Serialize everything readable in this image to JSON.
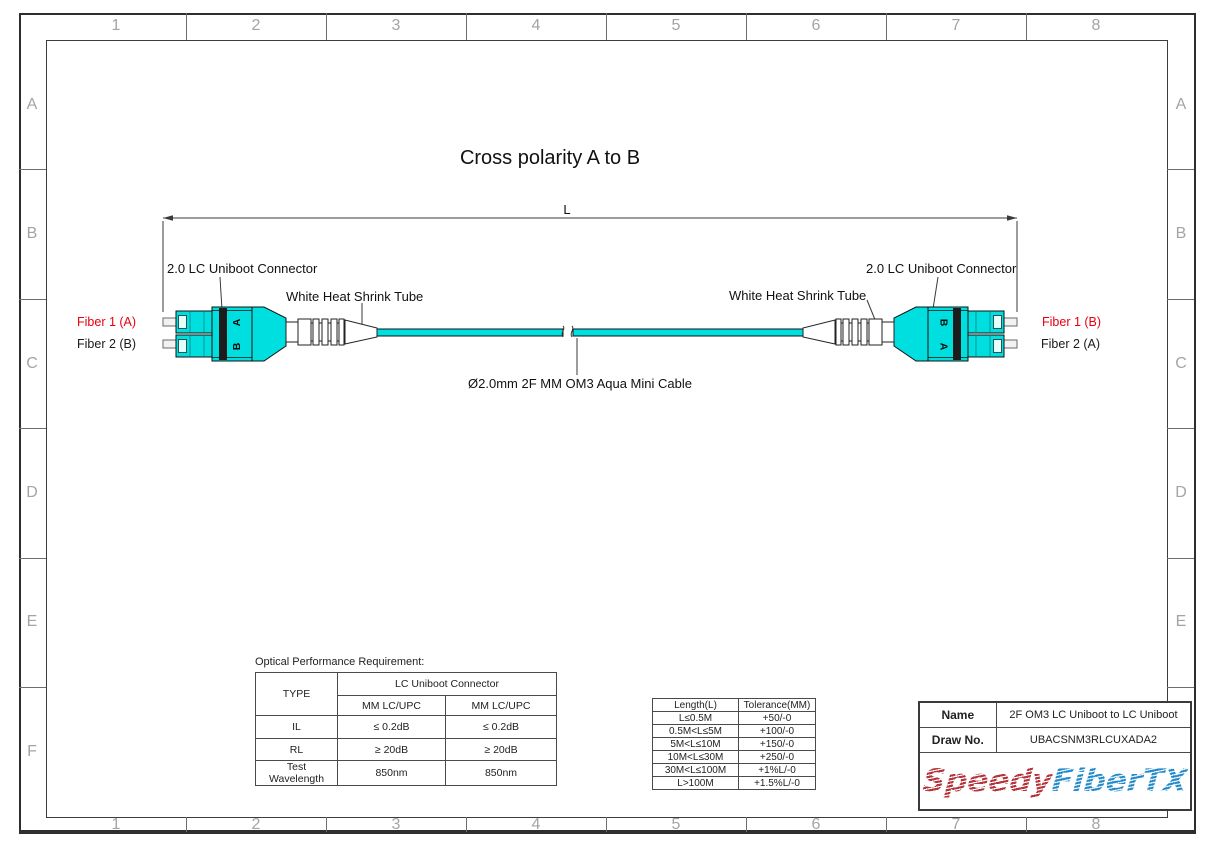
{
  "frame": {
    "columns": [
      "1",
      "2",
      "3",
      "4",
      "5",
      "6",
      "7",
      "8"
    ],
    "rows": [
      "A",
      "B",
      "C",
      "D",
      "E",
      "F"
    ]
  },
  "title": "Cross polarity A to B",
  "diagram": {
    "dimension_label": "L",
    "connector_label_left": "2.0 LC Uniboot Connector",
    "connector_label_right": "2.0 LC Uniboot Connector",
    "heat_shrink_label_left": "White Heat Shrink Tube",
    "heat_shrink_label_right": "White Heat Shrink Tube",
    "cable_label": "Ø2.0mm 2F MM OM3 Aqua Mini Cable",
    "fiber_labels_left": {
      "fiber1": "Fiber 1 (A)",
      "fiber2": "Fiber 2 (B)"
    },
    "fiber_labels_right": {
      "fiber1": "Fiber 1 (B)",
      "fiber2": "Fiber 2 (A)"
    },
    "polarity_letters_left": {
      "top": "A",
      "bottom": "B"
    },
    "polarity_letters_right": {
      "top": "B",
      "bottom": "A"
    },
    "colors": {
      "cable_aqua": "#00dfe0",
      "fiber1_label_red": "#e8000f",
      "heat_shrink_white": "#ffffff"
    }
  },
  "optical_table": {
    "caption": "Optical Performance Requirement:",
    "type_header": "TYPE",
    "group_header": "LC Uniboot Connector",
    "sub_headers": [
      "MM LC/UPC",
      "MM LC/UPC"
    ],
    "rows": [
      {
        "label": "IL",
        "col1": "≤ 0.2dB",
        "col2": "≤ 0.2dB"
      },
      {
        "label": "RL",
        "col1": "≥ 20dB",
        "col2": "≥ 20dB"
      },
      {
        "label": "Test Wavelength",
        "col1": "850nm",
        "col2": "850nm"
      }
    ]
  },
  "tolerance_table": {
    "headers": [
      "Length(L)",
      "Tolerance(MM)"
    ],
    "rows": [
      {
        "length": "L≤0.5M",
        "tolerance": "+50/-0"
      },
      {
        "length": "0.5M<L≤5M",
        "tolerance": "+100/-0"
      },
      {
        "length": "5M<L≤10M",
        "tolerance": "+150/-0"
      },
      {
        "length": "10M<L≤30M",
        "tolerance": "+250/-0"
      },
      {
        "length": "30M<L≤100M",
        "tolerance": "+1%L/-0"
      },
      {
        "length": "L>100M",
        "tolerance": "+1.5%L/-0"
      }
    ]
  },
  "title_block": {
    "name_label": "Name",
    "name_value": "2F OM3 LC Uniboot to LC Uniboot",
    "draw_no_label": "Draw No.",
    "draw_no_value": "UBACSNM3RLCUXADA2",
    "logo": {
      "part1": "Speedy",
      "part2": "FiberTX"
    }
  }
}
